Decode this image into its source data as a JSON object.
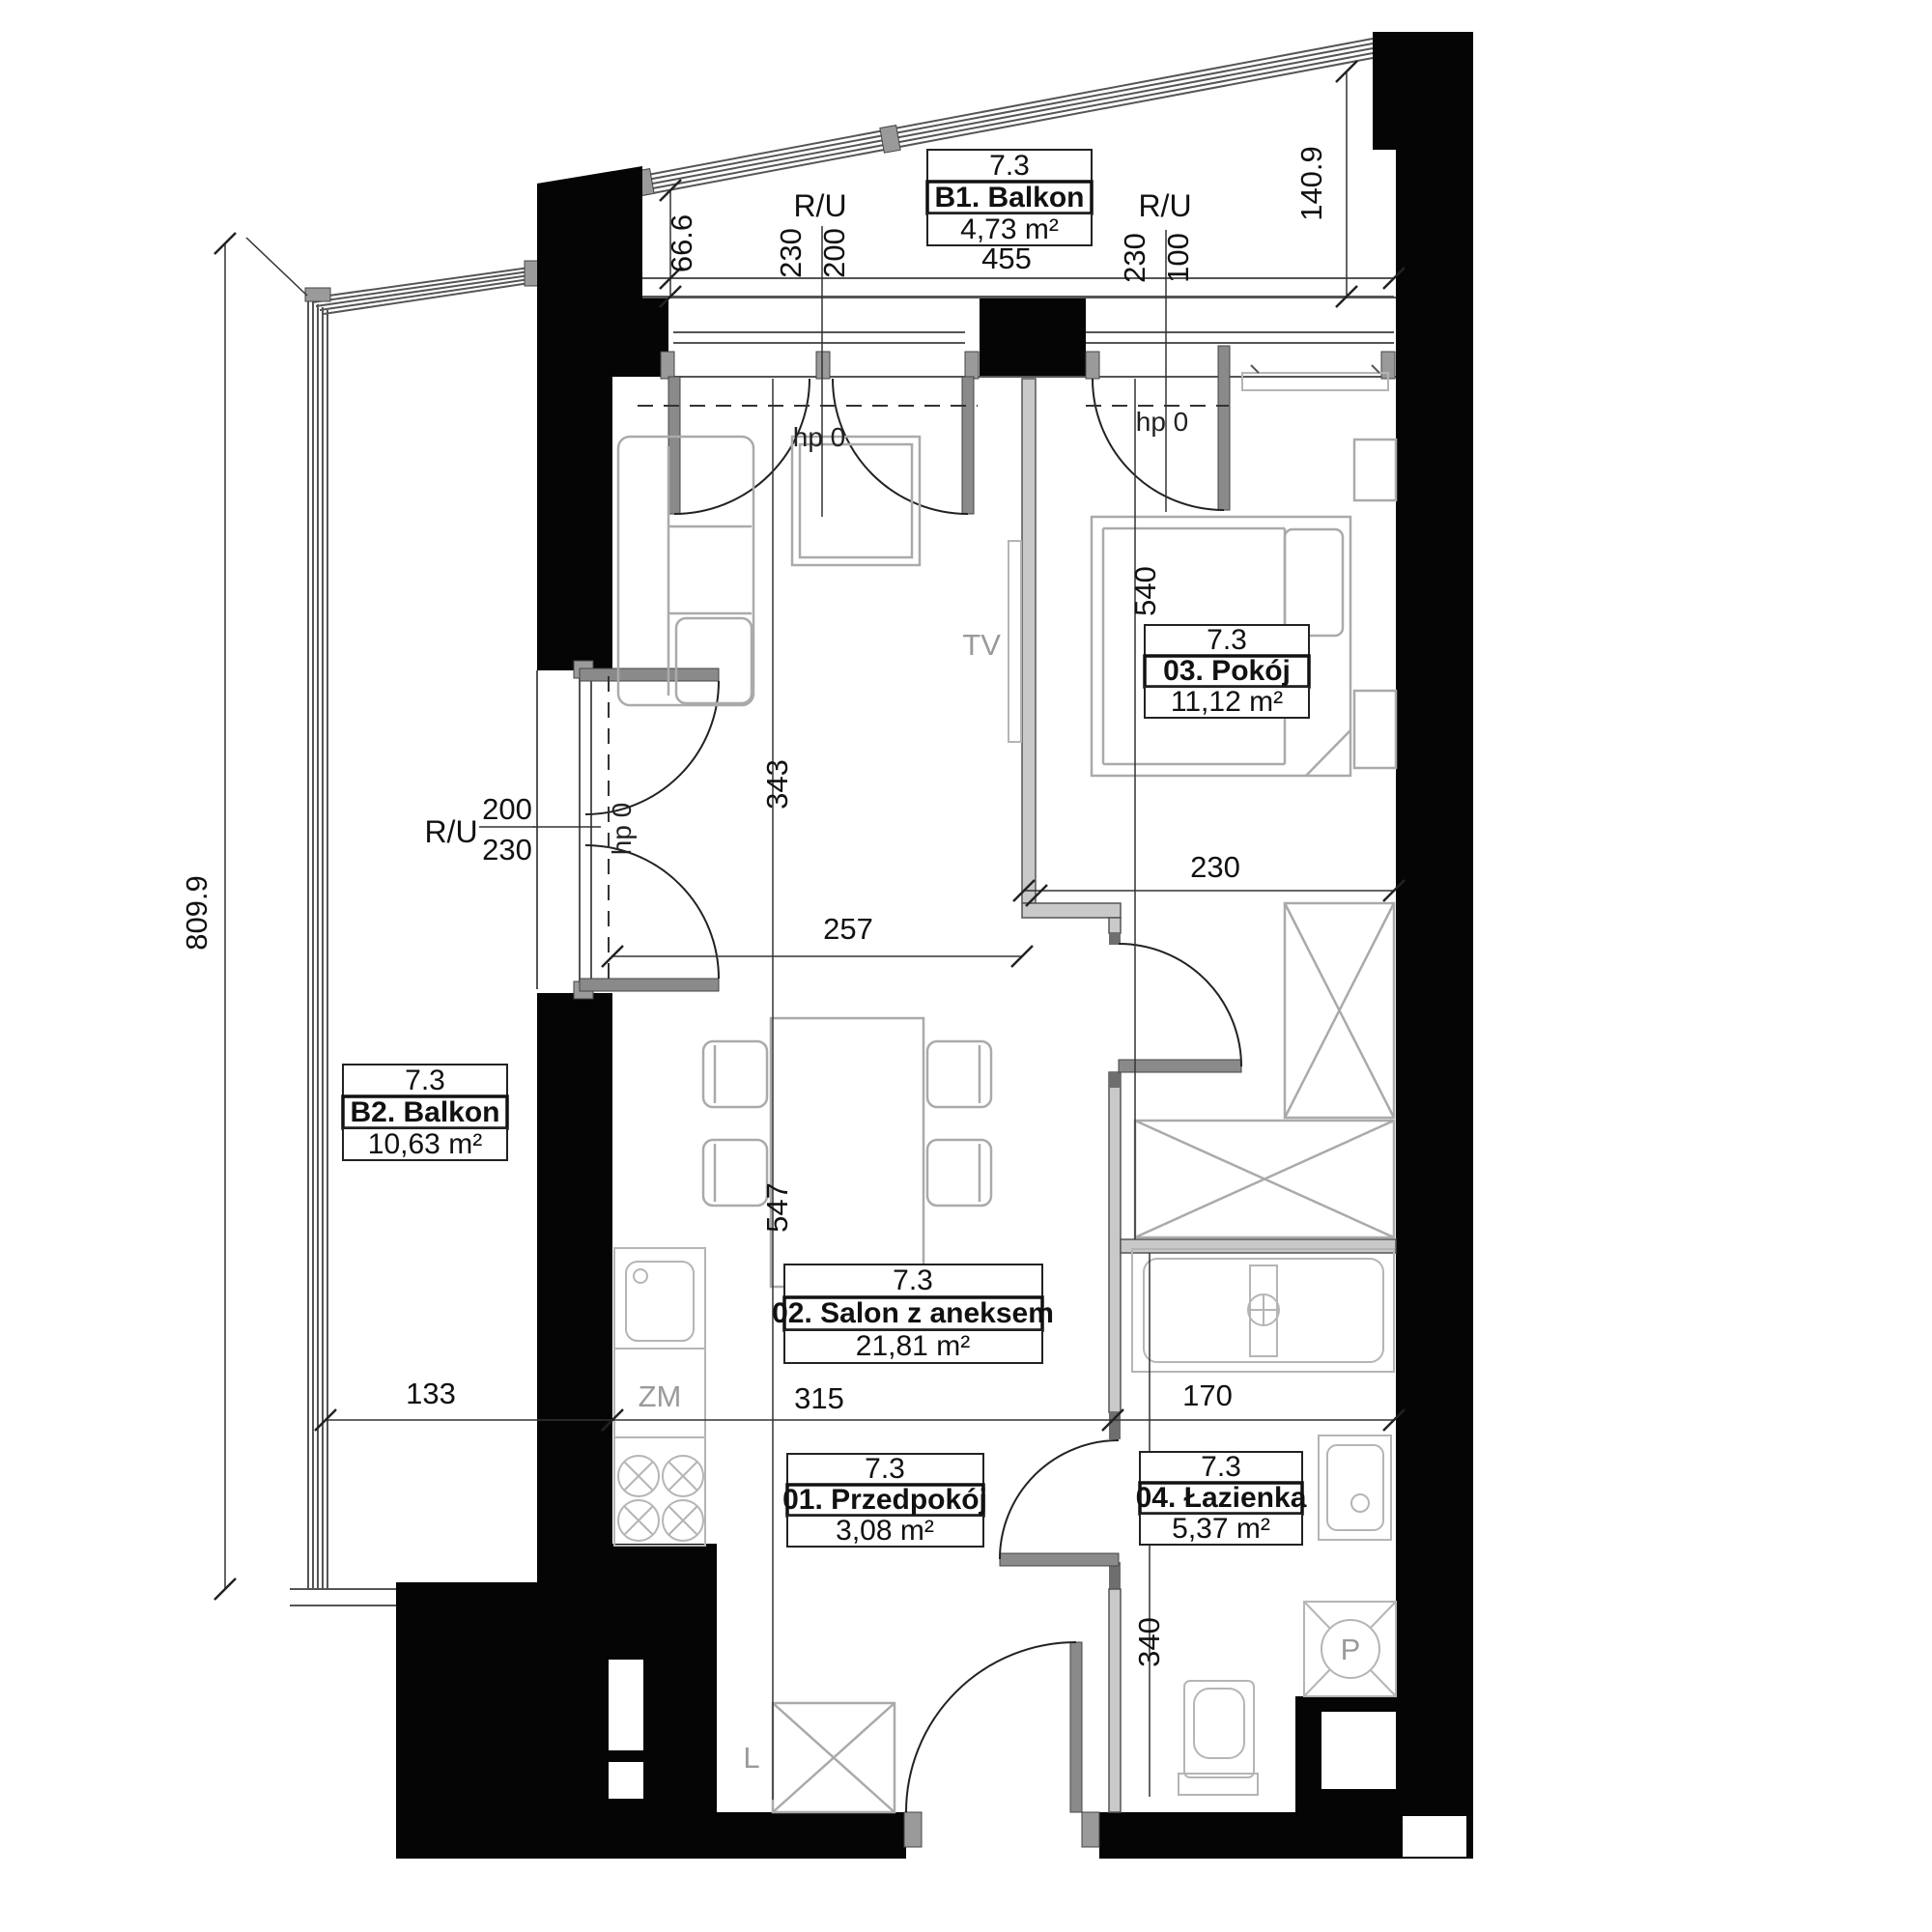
{
  "unit": "7.3",
  "rooms": {
    "przedpokoj": {
      "unit": "7.3",
      "name": "01. Przedpokój",
      "area": "3,08 m²"
    },
    "salon": {
      "unit": "7.3",
      "name": "02. Salon z aneksem",
      "area": "21,81 m²"
    },
    "pokoj": {
      "unit": "7.3",
      "name": "03. Pokój",
      "area": "11,12 m²"
    },
    "lazienka": {
      "unit": "7.3",
      "name": "04. Łazienka",
      "area": "5,37 m²"
    },
    "balkon1": {
      "unit": "7.3",
      "name": "B1. Balkon",
      "area": "4,73 m²"
    },
    "balkon2": {
      "unit": "7.3",
      "name": "B2. Balkon",
      "area": "10,63 m²"
    }
  },
  "dims": {
    "d455": "455",
    "d66_6": "66.6",
    "d140_9": "140.9",
    "d809_9": "809.9",
    "d343": "343",
    "d547": "547",
    "d257": "257",
    "d230room": "230",
    "d540": "540",
    "d133": "133",
    "d315": "315",
    "d170": "170",
    "d340": "340"
  },
  "windows": {
    "ru": "R/U",
    "n200": "200",
    "n230a": "230",
    "n230b": "230",
    "n100": "100",
    "ru_left": "R/U",
    "l200": "200",
    "l230": "230",
    "hp1": "hp 0",
    "hp2": "hp 0",
    "hp3": "hp 0"
  },
  "markers": {
    "tv": "TV",
    "zm": "ZM",
    "l": "L",
    "p": "P"
  },
  "colors": {
    "wall": "#050505",
    "partition": "#c9c9c9",
    "furniture": "#aaaaaa",
    "text": "#111111"
  }
}
